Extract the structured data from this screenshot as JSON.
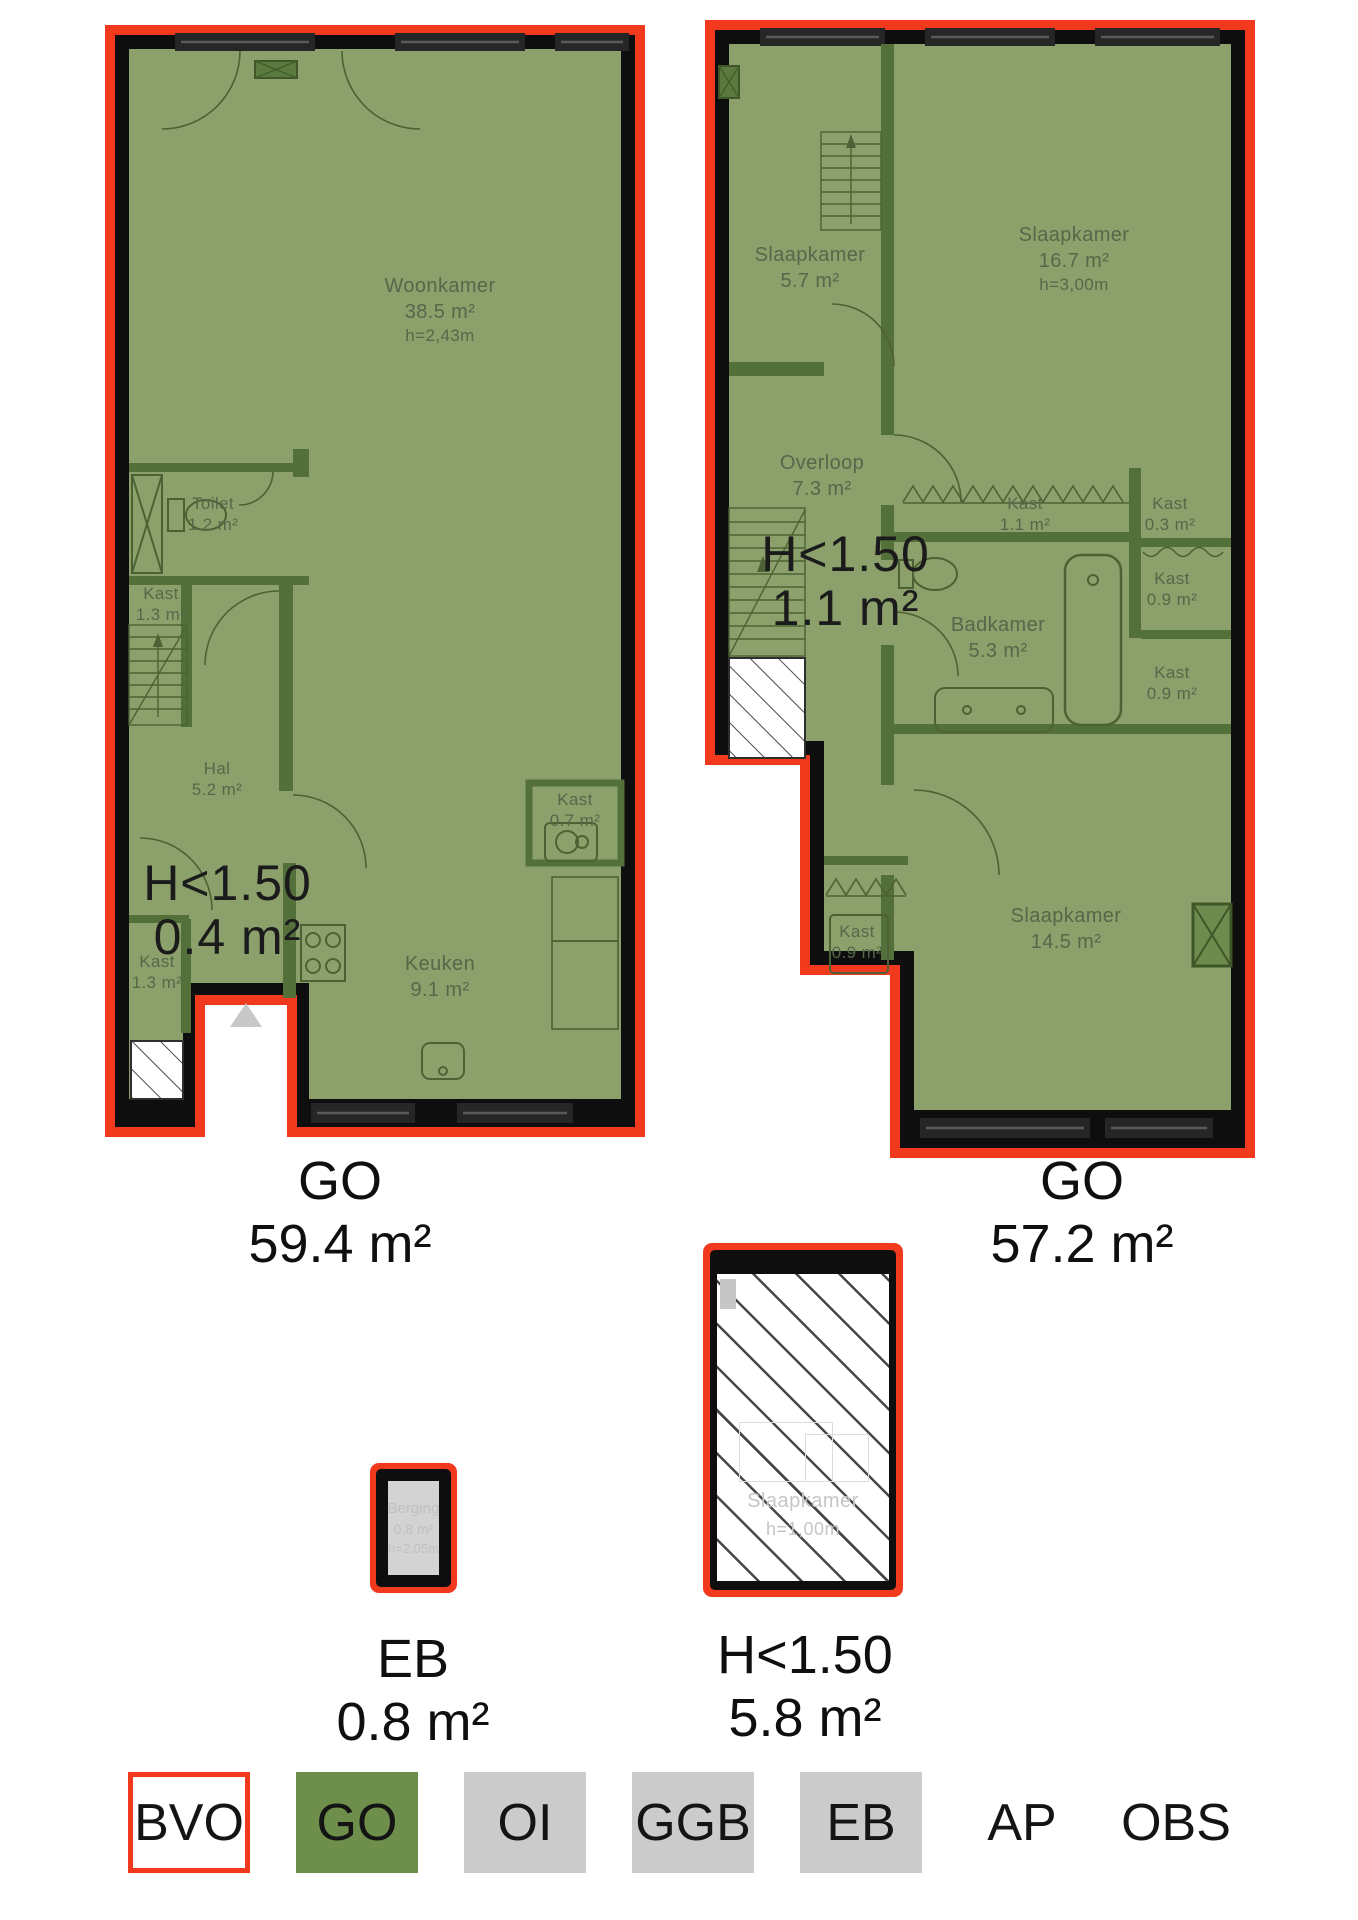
{
  "plan_left": {
    "rooms": {
      "woonkamer": {
        "name": "Woonkamer",
        "area": "38.5 m²",
        "height": "h=2,43m"
      },
      "toilet": {
        "name": "Toilet",
        "area": "1.2 m²"
      },
      "kast_mid": {
        "name": "Kast",
        "area": "1.3 m²"
      },
      "hal": {
        "name": "Hal",
        "area": "5.2 m²"
      },
      "kast_bottom": {
        "name": "Kast",
        "area": "1.3 m²"
      },
      "keuken": {
        "name": "Keuken",
        "area": "9.1 m²"
      },
      "kast_small": {
        "name": "Kast",
        "area": "0.7 m²"
      }
    },
    "low_headroom": {
      "line1": "H<1.50",
      "line2": "0.4 m²"
    },
    "caption": {
      "code": "GO",
      "area": "59.4 m²"
    }
  },
  "plan_right": {
    "rooms": {
      "slaapkamer_small": {
        "name": "Slaapkamer",
        "area": "5.7 m²"
      },
      "slaapkamer_large": {
        "name": "Slaapkamer",
        "area": "16.7 m²",
        "height": "h=3,00m"
      },
      "overloop": {
        "name": "Overloop",
        "area": "7.3 m²"
      },
      "kast_11": {
        "name": "Kast",
        "area": "1.1 m²"
      },
      "kast_03": {
        "name": "Kast",
        "area": "0.3 m²"
      },
      "kast_09_top": {
        "name": "Kast",
        "area": "0.9 m²"
      },
      "badkamer": {
        "name": "Badkamer",
        "area": "5.3 m²"
      },
      "kast_09_mid": {
        "name": "Kast",
        "area": "0.9 m²"
      },
      "kast_09_bottom": {
        "name": "Kast",
        "area": "0.9 m²"
      },
      "slaapkamer_bottom": {
        "name": "Slaapkamer",
        "area": "14.5 m²"
      }
    },
    "low_headroom": {
      "line1": "H<1.50",
      "line2": "1.1 m²"
    },
    "caption": {
      "code": "GO",
      "area": "57.2 m²"
    }
  },
  "plan_eb": {
    "room": {
      "name": "Berging",
      "area": "0.8 m²",
      "height": "h=2,05m"
    },
    "caption": {
      "code": "EB",
      "area": "0.8 m²"
    }
  },
  "plan_attic": {
    "room": {
      "name": "Slaapkamer",
      "height": "h=1,00m"
    },
    "caption": {
      "code": "H<1.50",
      "area": "5.8 m²"
    }
  },
  "legend": {
    "items": [
      {
        "label": "BVO"
      },
      {
        "label": "GO"
      },
      {
        "label": "OI"
      },
      {
        "label": "GGB"
      },
      {
        "label": "EB"
      },
      {
        "label": "AP"
      },
      {
        "label": "OBS"
      }
    ]
  },
  "colors": {
    "outline_red": "#f0391d",
    "go_green": "#8ca06b",
    "partition_green": "#53703a",
    "wall_black": "#0e0e0e",
    "legend_green": "#6e8f4b",
    "legend_gray": "#cbcbcb"
  }
}
